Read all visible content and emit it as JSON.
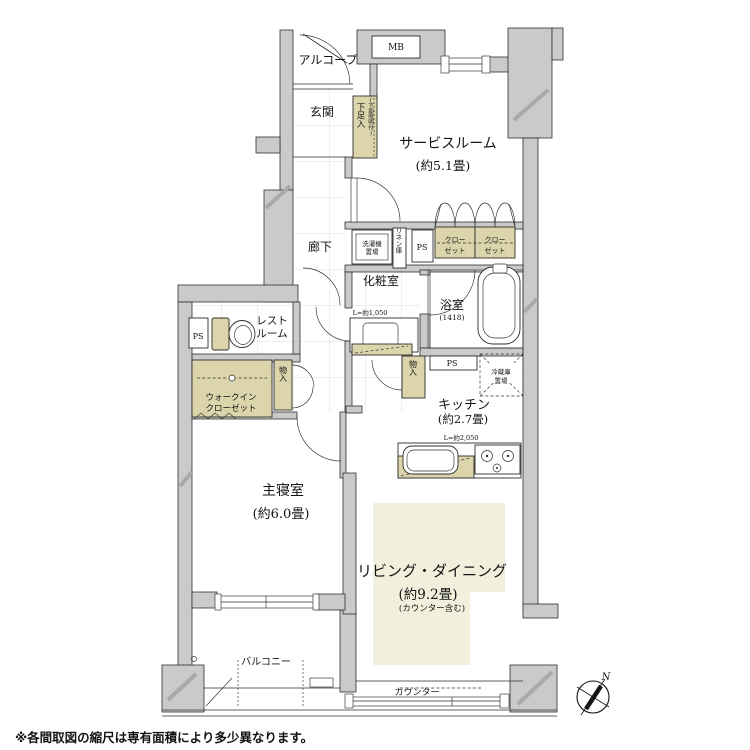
{
  "footnote": "※各間取図の縮尺は専有面積により多少異なります。",
  "compass": {
    "north": "N"
  },
  "colors": {
    "wall": "#cacaca",
    "fixture_tan": "#dcd4ab",
    "living_cream": "#f2efdc",
    "line": "#2e2e2e",
    "grid": "#dcdcdc"
  },
  "labels": {
    "alcove": "アルコープ",
    "mb": "MB",
    "genkan": "玄関",
    "shoe": "下足入",
    "shoe_note": "(下部照明付)",
    "service": "サービスルーム",
    "service_size": "(約5.1畳)",
    "hall": "廊下",
    "washer_1": "洗濯機",
    "washer_2": "置場",
    "linen": "リネン庫",
    "ps": "PS",
    "closet_1": "クロー",
    "closet_2": "ゼット",
    "powder": "化粧室",
    "vanity_dim": "L=約1,050",
    "bath": "浴室",
    "bath_size": "(1418)",
    "rest_1": "レスト",
    "rest_2": "ルーム",
    "wic_1": "ウォークイン",
    "wic_2": "クローゼット",
    "storage": "物入",
    "fridge_1": "冷蔵庫",
    "fridge_2": "置場",
    "kitchen": "キッチン",
    "kitchen_size": "(約2.7畳)",
    "kitchen_dim": "L=約2,050",
    "bedroom": "主寝室",
    "bedroom_size": "(約6.0畳)",
    "living": "リビング・ダイニング",
    "living_size": "(約9.2畳)",
    "living_note": "(カウンター含む)",
    "counter": "カウンター",
    "balcony": "バルコニー"
  }
}
